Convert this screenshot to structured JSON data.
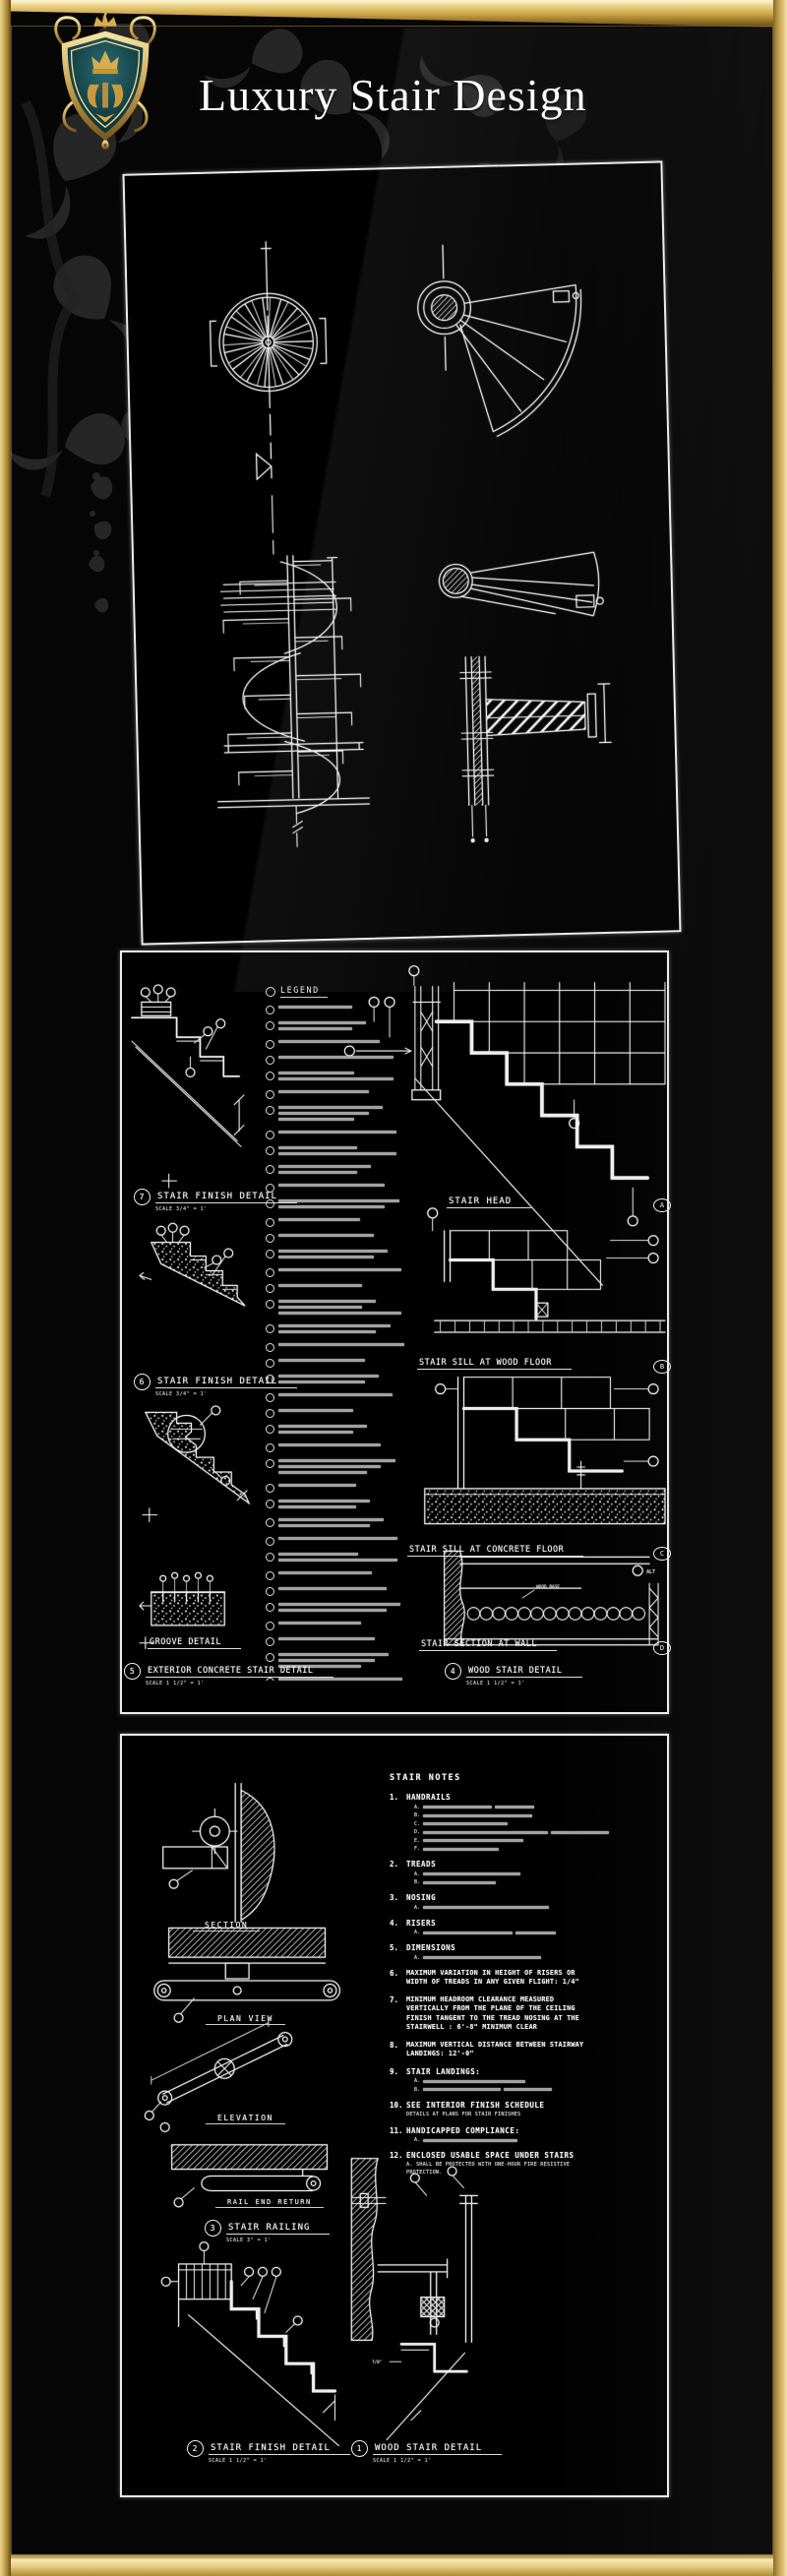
{
  "header": {
    "title": "Luxury Stair Design",
    "logo": "royal-crest-shield"
  },
  "colors": {
    "frame_gold": "#d4af54",
    "line_white": "#efefef",
    "background": "#060606",
    "crest_teal": "#1d5f66",
    "crest_gold": "#c9972b"
  },
  "panel1": {
    "name": "spiral stair details sheet",
    "drawings": [
      "spiral stair plan",
      "fan stair plan",
      "spiral stair elevation",
      "fan tread elevation",
      "center post tread bracket section"
    ]
  },
  "panel2": {
    "legend": {
      "title": "LEGEND",
      "item_count": 40
    },
    "left_details": [
      {
        "num": "7",
        "title": "STAIR FINISH DETAIL",
        "scale": "SCALE 3/4\" = 1'"
      },
      {
        "num": "6",
        "title": "STAIR FINISH DETAIL",
        "scale": "SCALE 3/4\" = 1'"
      },
      {
        "num": "",
        "title": "GROOVE DETAIL",
        "scale": ""
      },
      {
        "num": "5",
        "title": "EXTERIOR CONCRETE STAIR DETAIL",
        "scale": "SCALE 1 1/2\" = 1'"
      }
    ],
    "right_details": [
      {
        "letter": "A",
        "title": "STAIR HEAD"
      },
      {
        "letter": "B",
        "title": "STAIR SILL AT WOOD FLOOR"
      },
      {
        "letter": "C",
        "title": "STAIR SILL AT CONCRETE FLOOR"
      },
      {
        "letter": "D",
        "title": "STAIR SECTION AT WALL"
      }
    ],
    "detail4": {
      "num": "4",
      "title": "WOOD STAIR DETAIL",
      "scale": "SCALE 1 1/2\" = 1'"
    },
    "annotations": {
      "wood_base": "WOOD BASE",
      "alt": "ALT"
    }
  },
  "panel3": {
    "labels": {
      "section": "SECTION",
      "plan_view": "PLAN VIEW",
      "elevation": "ELEVATION",
      "rail_end_return": "RAIL END RETURN"
    },
    "details": [
      {
        "num": "3",
        "title": "STAIR RAILING",
        "scale": "SCALE 3\" = 1'"
      },
      {
        "num": "2",
        "title": "STAIR FINISH DETAIL",
        "scale": "SCALE 1 1/2\" = 1'"
      },
      {
        "num": "1",
        "title": "WOOD STAIR DETAIL",
        "scale": "SCALE 1 1/2\" = 1'"
      }
    ],
    "annotations": {
      "seven_eighths": "7/8\""
    },
    "notes": {
      "title": "STAIR NOTES",
      "items": [
        {
          "num": "1.",
          "title": "HANDRAILS",
          "subs": [
            "A.",
            "B.",
            "C.",
            "D.",
            "E.",
            "F."
          ]
        },
        {
          "num": "2.",
          "title": "TREADS",
          "subs": [
            "A.",
            "B."
          ]
        },
        {
          "num": "3.",
          "title": "NOSING",
          "subs": [
            "A."
          ]
        },
        {
          "num": "4.",
          "title": "RISERS",
          "subs": [
            "A."
          ]
        },
        {
          "num": "5.",
          "title": "DIMENSIONS",
          "subs": [
            "A."
          ]
        },
        {
          "num": "6.",
          "text": "MAXIMUM VARIATION IN HEIGHT OF RISERS OR WIDTH OF TREADS IN ANY GIVEN FLIGHT: 1/4\""
        },
        {
          "num": "7.",
          "text": "MINIMUM HEADROOM CLEARANCE MEASURED VERTICALLY FROM THE PLANE OF THE CEILING FINISH TANGENT TO THE TREAD NOSING AT THE STAIRWELL : 6'-8\" MINIMUM CLEAR"
        },
        {
          "num": "8.",
          "text": "MAXIMUM VERTICAL DISTANCE BETWEEN STAIRWAY LANDINGS: 12'-0\""
        },
        {
          "num": "9.",
          "title": "STAIR LANDINGS:",
          "subs": [
            "A.",
            "B."
          ]
        },
        {
          "num": "10.",
          "title": "SEE INTERIOR FINISH SCHEDULE",
          "note": "DETAILS AT PLANS FOR STAIR FINISHES"
        },
        {
          "num": "11.",
          "title": "HANDICAPPED COMPLIANCE:",
          "subs": [
            "A."
          ]
        },
        {
          "num": "12.",
          "title": "ENCLOSED USABLE SPACE UNDER STAIRS",
          "note": "A. SHALL BE PROTECTED WITH ONE-HOUR FIRE RESISTIVE PROTECTION."
        }
      ]
    }
  }
}
